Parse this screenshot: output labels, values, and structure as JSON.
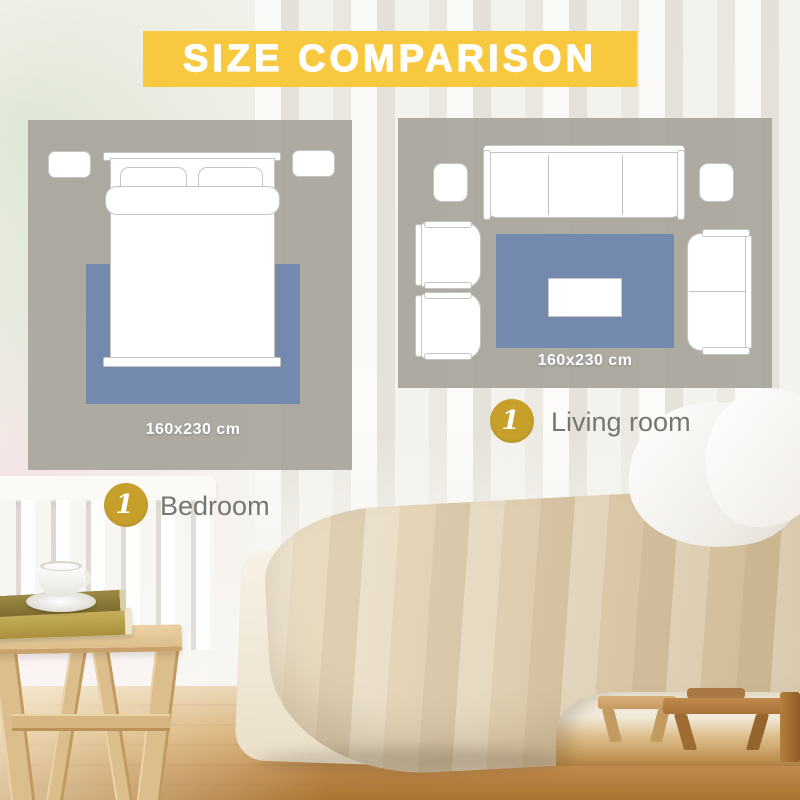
{
  "banner": {
    "title": "SIZE COMPARISON"
  },
  "colors": {
    "banner_yellow": "#F8C93E",
    "badge_gold": "#C6A02B",
    "rug_blue": "#7389AE",
    "panel_gray": "rgba(167,164,155,0.92)",
    "label_gray": "#77756F",
    "size_text": "#FFFFFF"
  },
  "rooms": [
    {
      "name": "Bedroom",
      "number": "1",
      "rug_size": "160x230 cm"
    },
    {
      "name": "Living room",
      "number": "1",
      "rug_size": "160x230 cm"
    }
  ]
}
